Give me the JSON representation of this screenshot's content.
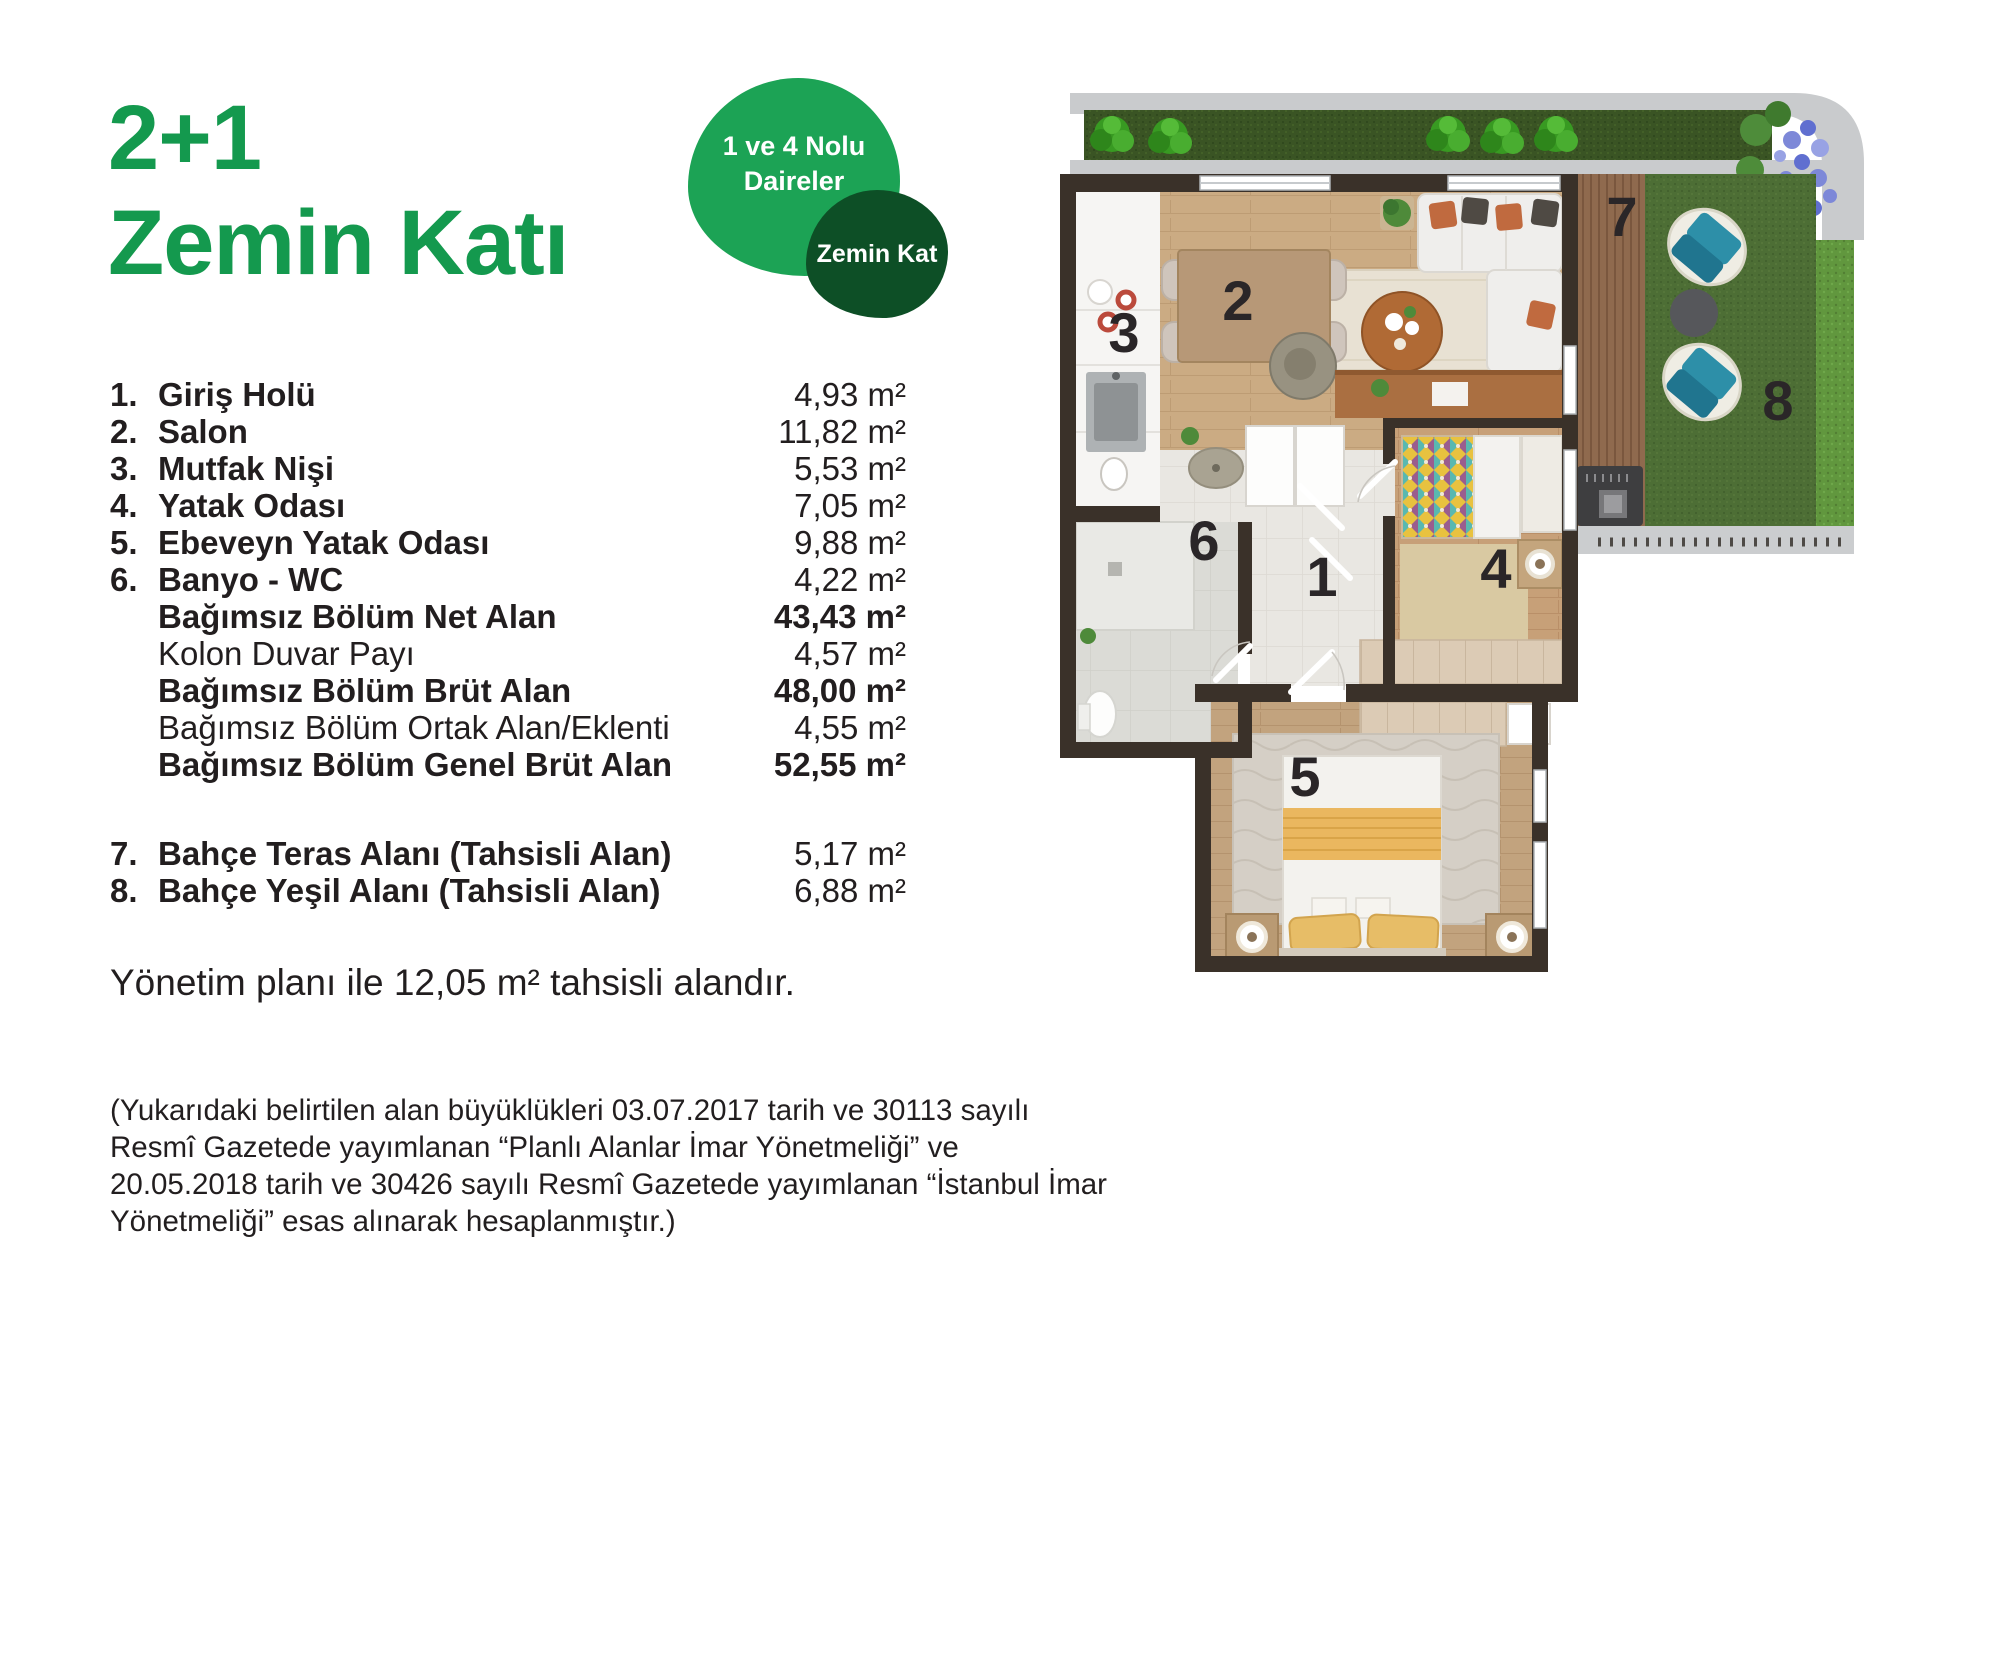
{
  "title": {
    "line1": "2+1",
    "line2": "Zemin Katı"
  },
  "badge": {
    "primary_line1": "1 ve 4 Nolu",
    "primary_line2": "Daireler",
    "secondary": "Zemin Kat"
  },
  "room_list": {
    "items": [
      {
        "prefix": "1.",
        "label": "Giriş Holü",
        "value": "4,93 m²",
        "label_bold": true
      },
      {
        "prefix": "2.",
        "label": "Salon",
        "value": "11,82 m²",
        "label_bold": true
      },
      {
        "prefix": "3.",
        "label": "Mutfak Nişi",
        "value": "5,53 m²",
        "label_bold": true
      },
      {
        "prefix": "4.",
        "label": "Yatak Odası",
        "value": "7,05 m²",
        "label_bold": true
      },
      {
        "prefix": "5.",
        "label": "Ebeveyn Yatak Odası",
        "value": "9,88 m²",
        "label_bold": true
      },
      {
        "prefix": "6.",
        "label": "Banyo - WC",
        "value": "4,22 m²",
        "label_bold": true
      },
      {
        "prefix": "",
        "label": "Bağımsız Bölüm Net Alan",
        "value": "43,43 m²",
        "label_bold": true,
        "value_bold": true
      },
      {
        "prefix": "",
        "label": "Kolon Duvar Payı",
        "value": "4,57 m²"
      },
      {
        "prefix": "",
        "label": "Bağımsız Bölüm Brüt Alan",
        "value": "48,00 m²",
        "label_bold": true,
        "value_bold": true
      },
      {
        "prefix": "",
        "label": "Bağımsız Bölüm Ortak Alan/Eklenti",
        "value": "4,55 m²"
      },
      {
        "prefix": "",
        "label": "Bağımsız Bölüm Genel Brüt Alan",
        "value": "52,55 m²",
        "label_bold": true,
        "value_bold": true
      },
      {
        "prefix": "7.",
        "label": "Bahçe Teras Alanı (Tahsisli Alan)",
        "value": "5,17 m²",
        "label_bold": true,
        "gap_before": true
      },
      {
        "prefix": "8.",
        "label": "Bahçe Yeşil Alanı (Tahsisli Alan)",
        "value": "6,88 m²",
        "label_bold": true
      }
    ]
  },
  "note": {
    "text": "Yönetim planı ile 12,05 m² tahsisli alandır."
  },
  "disclaimer": {
    "lines": [
      "(Yukarıdaki belirtilen alan büyüklükleri 03.07.2017 tarih ve 30113 sayılı",
      "Resmî Gazetede yayımlanan “Planlı Alanlar İmar Yönetmeliği” ve",
      "20.05.2018 tarih ve 30426 sayılı Resmî Gazetede yayımlanan “İstanbul İmar",
      "Yönetmeliği” esas alınarak hesaplanmıştır.)"
    ]
  },
  "floor_plan": {
    "room_numbers": [
      "1",
      "2",
      "3",
      "4",
      "5",
      "6",
      "7",
      "8"
    ]
  },
  "colors": {
    "brand_green": "#14994e",
    "badge_green": "#1ca355",
    "badge_dark_green": "#0d4f26",
    "text": "#221e1f",
    "wall": "#3a3129",
    "grass": "#4d6e35",
    "hedge_dark": "#3a5424",
    "hedge_bright": "#61973e",
    "deck_wood": "#8f6a4e",
    "terrace_chair_teal": "#2d8fa8",
    "living_floor": "#cbab83",
    "pavement_gray": "#c9cbcd"
  }
}
